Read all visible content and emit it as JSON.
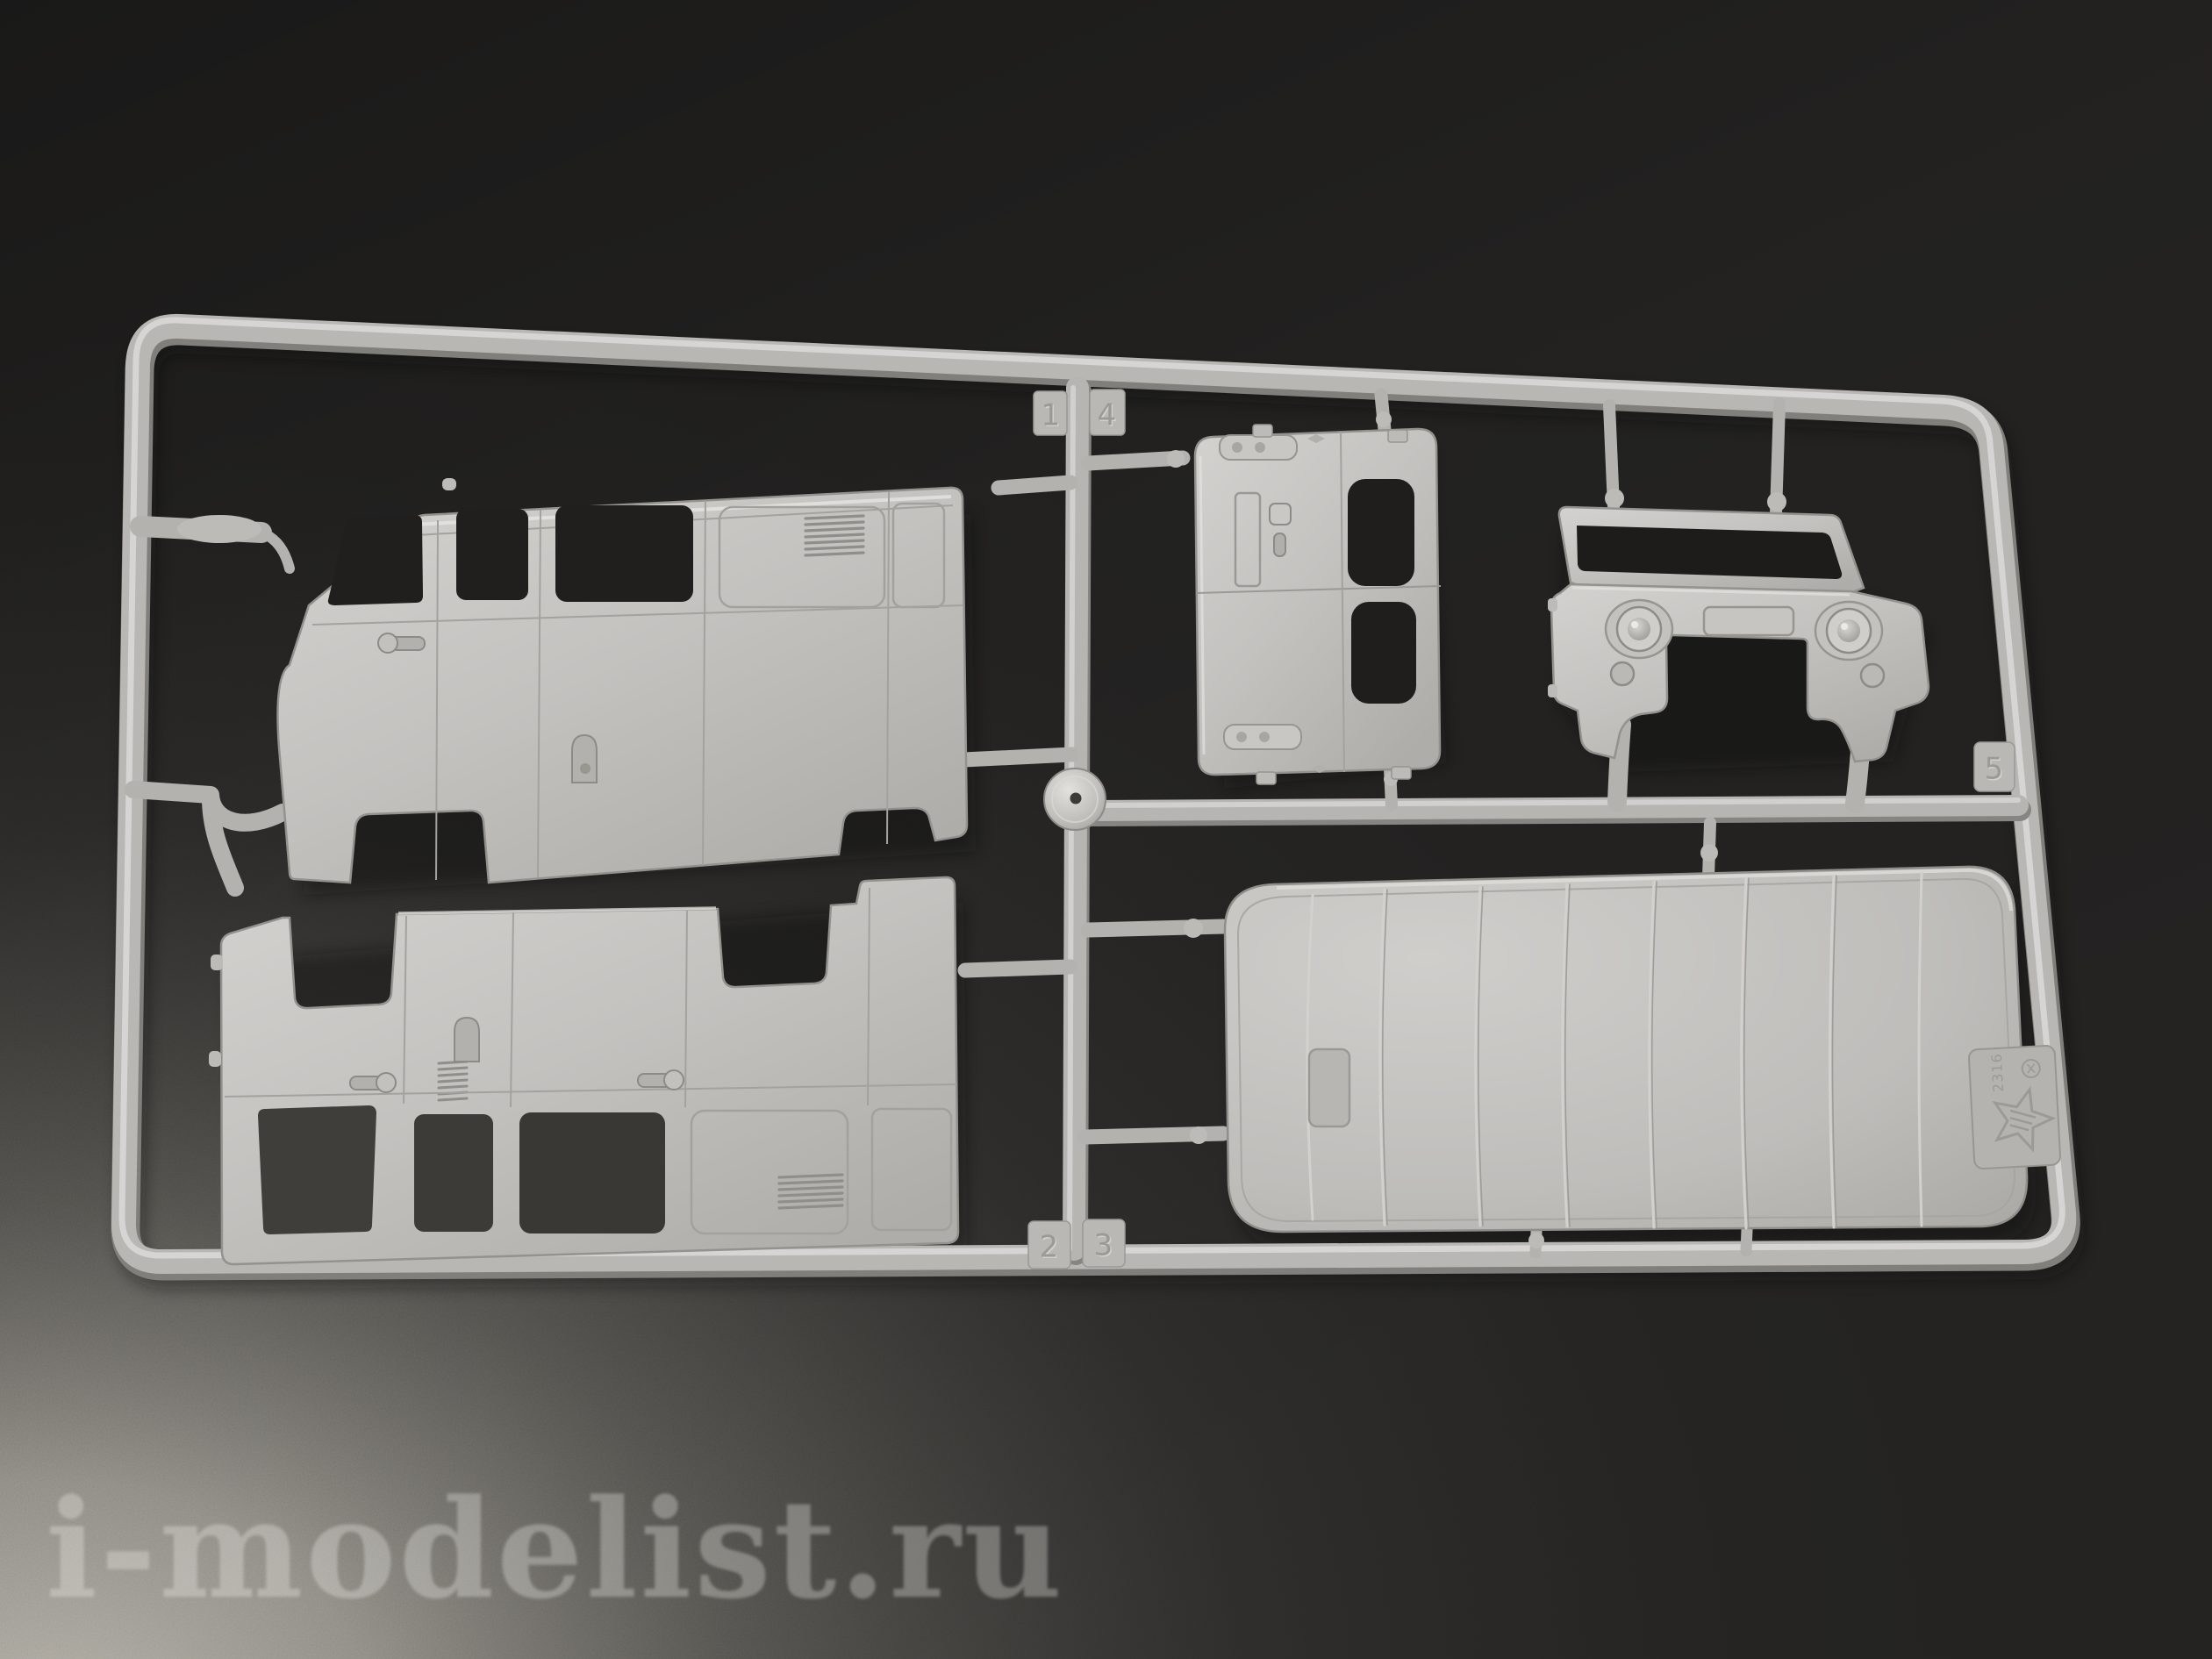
{
  "image": {
    "type": "product-photo",
    "subject": "grey injection-moulded sprue with UAZ van model kit body parts",
    "plastic_color": "#c6c5c2",
    "background_dark": "#232221",
    "background_light": "#b3afa6"
  },
  "watermark": {
    "text": "i-modelist.ru"
  },
  "sprue": {
    "gate_tags": [
      {
        "label": "1"
      },
      {
        "label": "4"
      },
      {
        "label": "2"
      },
      {
        "label": "3"
      },
      {
        "label": "5"
      }
    ],
    "brand_tag": {
      "code": "2316",
      "logo": "zvezda-star"
    },
    "parts": [
      {
        "name": "body-side-panel-right"
      },
      {
        "name": "body-side-panel-left"
      },
      {
        "name": "rear-doors-panel"
      },
      {
        "name": "front-cab-panel"
      },
      {
        "name": "roof-panel"
      }
    ]
  }
}
